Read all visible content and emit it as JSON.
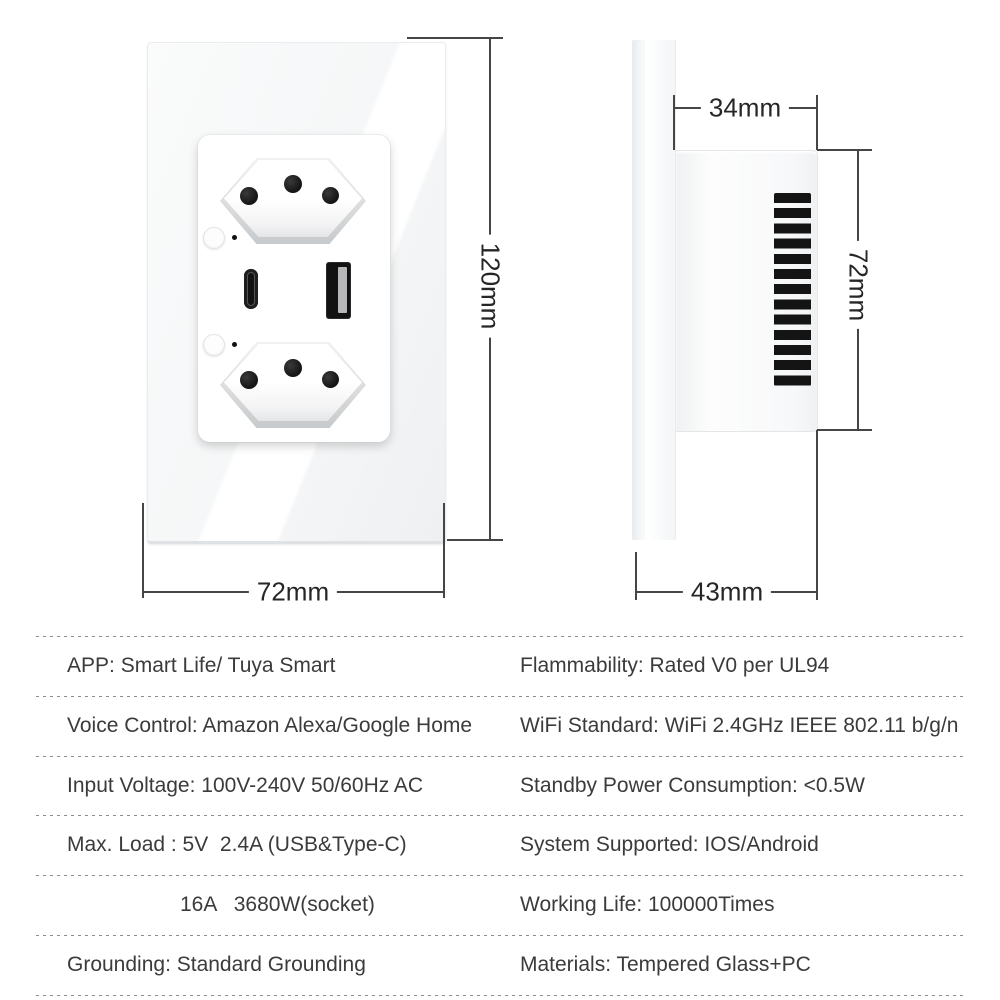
{
  "front_view": {
    "height_label": "120mm",
    "width_label": "72mm"
  },
  "side_view": {
    "depth_label": "34mm",
    "height_label": "72mm",
    "base_width_label": "43mm"
  },
  "specs": {
    "rows": [
      {
        "left": "APP: Smart Life/ Tuya Smart",
        "right": "Flammability: Rated V0 per UL94"
      },
      {
        "left": "Voice Control: Amazon Alexa/Google Home",
        "right": "WiFi Standard: WiFi 2.4GHz IEEE 802.11 b/g/n"
      },
      {
        "left": "Input Voltage: 100V-240V 50/60Hz AC",
        "right": "Standby Power Consumption: <0.5W"
      },
      {
        "left": "Max. Load : 5V  2.4A (USB&Type-C)",
        "right": "System Supported: IOS/Android"
      },
      {
        "left": "16A   3680W(socket)",
        "right": "Working Life: 100000Times"
      },
      {
        "left": "Grounding: Standard Grounding",
        "right": "Materials: Tempered Glass+PC"
      }
    ]
  },
  "colors": {
    "dimension_line": "#454545",
    "spec_text": "#3b3b3b",
    "port_black": "#141414",
    "separator_dots": "#8c8c8c"
  }
}
